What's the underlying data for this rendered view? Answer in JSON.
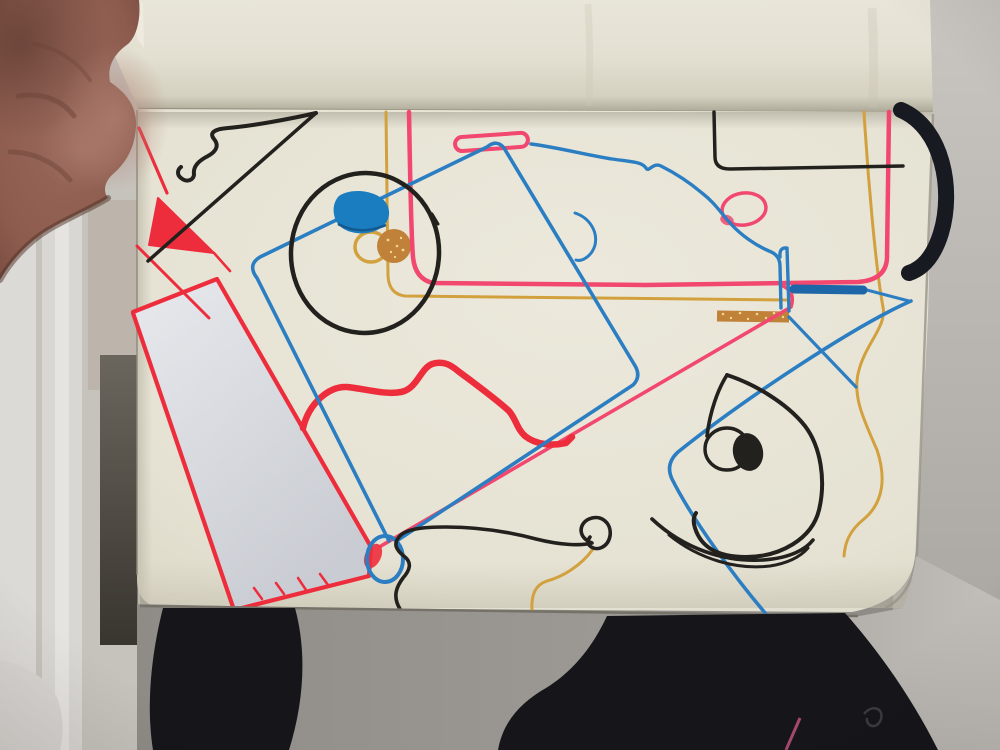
{
  "scene": {
    "type": "photograph",
    "description": "Top-down photo of an open cream sketchbook held at the left by a hand; the previous page is curled upward at the top. The page is covered in abstract marker doodles in blue, pink, red, gold and black ink. A white paper strip traced with red marker lies diagonally on the lower-left of the page. A black elastic band loops off the right page edge. Grey wall and floor surround the book and dark clothing fills the bottom of the frame."
  },
  "objects": {
    "hand": {
      "position": "top-left",
      "description": "thumb and palm of a hand gripping the notebook edge"
    },
    "notebook": {
      "description": "cream sketchbook with rounded corners",
      "curled_page": "blank previous page folded upward across the top",
      "elastic_band": "black elastic closure band bowed out at the right edge"
    },
    "paper_strip": {
      "description": "white rectangular paper strip laid diagonally over the lower-left page, outlined in red marker with small stitch ticks along its bottom edge"
    },
    "background": {
      "left": "white and grey furniture edges with a bright vertical highlight and a dark shadow slot beside the book",
      "right": "plain warm-grey wall",
      "bottom": "grey floor with black clothing (knee and garments), a small pink zipper line and a tiny dark cord curl"
    },
    "doodles": [
      {
        "name": "black-pennant",
        "ink": "black",
        "description": "wavy-topped pennant / arrow shape in the upper left with a long straight diagonal"
      },
      {
        "name": "red-edge-wedge",
        "ink": "red",
        "description": "thin diagonals and a solid red wedge at the page's left edge"
      },
      {
        "name": "black-ellipse",
        "ink": "black",
        "description": "large hand-drawn ellipse outline upper-centre"
      },
      {
        "name": "blue-blob",
        "ink": "blue",
        "description": "solid blue rounded blob inside the ellipse"
      },
      {
        "name": "gold-ring-blob",
        "ink": "gold",
        "description": "gold loop with a glitter-filled disc inside the ellipse"
      },
      {
        "name": "pink-gold-rounded-rect",
        "ink": "pink and gold",
        "description": "large pink rounded rectangle spanning the top of the page with a parallel gold line"
      },
      {
        "name": "pink-pill",
        "ink": "pink",
        "description": "small horizontal pill outline top-centre"
      },
      {
        "name": "blue-tilted-rect",
        "ink": "blue",
        "description": "big tilted rounded rectangle crossing the page through the ellipse"
      },
      {
        "name": "blue-cloud",
        "ink": "blue",
        "description": "cloud-like squiggle ending in a narrow vertical pill"
      },
      {
        "name": "blue-c-hook",
        "ink": "blue",
        "description": "small crescent hook below the cloud"
      },
      {
        "name": "pink-small-circle",
        "ink": "pink",
        "description": "small pink circle with a smudge, mid-right"
      },
      {
        "name": "black-bracket",
        "ink": "black",
        "description": "rounded-corner bracket line in the upper right"
      },
      {
        "name": "blue-thick-dash",
        "ink": "blue",
        "description": "thick blue marker dash over the pink line, right side"
      },
      {
        "name": "gold-glitter-dash",
        "ink": "gold glitter",
        "description": "thick sparkly gold dash below the blue dash"
      },
      {
        "name": "pink-diagonal",
        "ink": "pink",
        "description": "long diagonal hooking down from the pink rectangle to the blue circle"
      },
      {
        "name": "red-thick-wavy",
        "ink": "red",
        "description": "thick wavy mountain-shaped red line mid-page"
      },
      {
        "name": "blue-small-circle",
        "ink": "blue",
        "description": "small blue circle at the strip's lower corner"
      },
      {
        "name": "black-balloon-squiggle",
        "ink": "black and gold",
        "description": "snaking line ending in a loop with a gold tail to the page edge"
      },
      {
        "name": "black-eye-doodle",
        "ink": "black",
        "description": "pointed eye/fish outline with filled pupil, highlight circle and smile arcs, lower right"
      },
      {
        "name": "blue-corner-line",
        "ink": "blue",
        "description": "rounded corner of another tilted rectangle, bottom right"
      },
      {
        "name": "gold-wavy-right",
        "ink": "gold",
        "description": "long wavy gold line down the right margin"
      }
    ]
  },
  "palette": {
    "page_cream": "#e7e4d6",
    "curled_page": "#e3e0d2",
    "strip_white": "#dfe1e6",
    "wall_gray": "#b5b1ad",
    "left_bg": "#c6c3bd",
    "left_white_band": "#dcdad6",
    "dark_shadow": "#4a453e",
    "floor_gray": "#9b9893",
    "clothing_black": "#15151a",
    "band_black": "#181a21",
    "skin_base": "#8d5c4e",
    "skin_shadow": "#55332a",
    "skin_light": "#b28274",
    "blue": "#2b7ec2",
    "blue_dark": "#1d66a8",
    "blue_fill": "#1a7dc0",
    "pink": "#f2476e",
    "red": "#ee2d3c",
    "gold": "#d2a13e",
    "gold_dark": "#c08138",
    "gold_sparkle": "#f2d694",
    "black_ink": "#23211e",
    "zipper_pink": "#a6486e"
  }
}
